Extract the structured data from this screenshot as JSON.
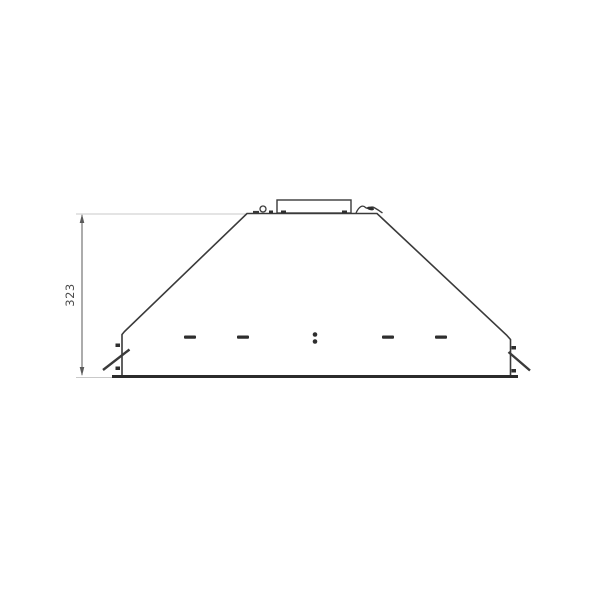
{
  "drawing": {
    "type": "technical-elevation-extractor-hood",
    "dimension_label": "323",
    "front_panel_marks": {
      "slot_count": 4,
      "dot_count": 2
    },
    "colors": {
      "background": "#ffffff",
      "line": "#3a3a3a",
      "thick_line": "#2b2b2b",
      "construction_line": "#c9c9c9",
      "dimension_line": "#5a5a5a",
      "text": "#4a4a4a",
      "mark_fill": "#2e2e2e"
    }
  }
}
